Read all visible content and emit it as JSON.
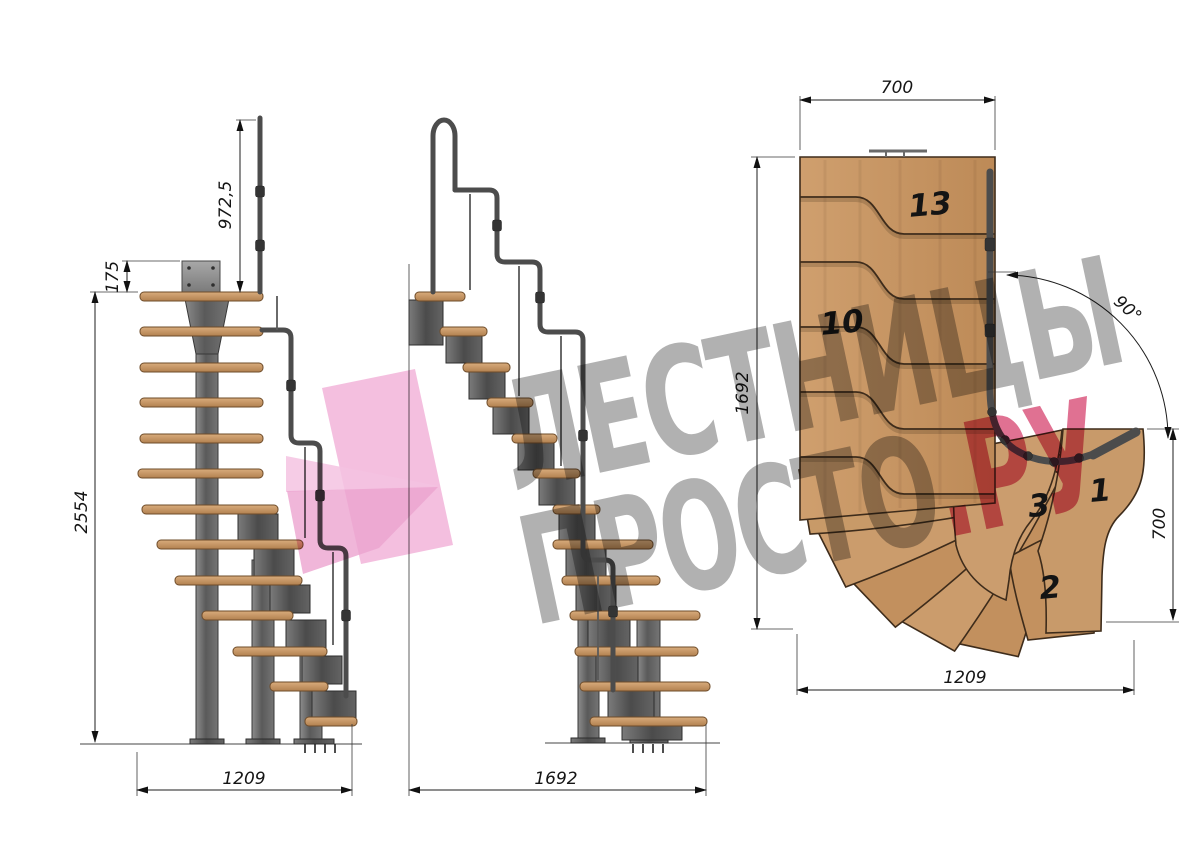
{
  "title": "Modular staircase technical drawing",
  "watermark": {
    "line1": "ЛЕСТНИЦЫ",
    "line2": "ПРОСТО",
    "suffix": ".РУ"
  },
  "views": {
    "side": {
      "label": "side-elevation",
      "dim_rail_height": "972,5",
      "dim_top_offset": "175",
      "dim_total_height": "2554",
      "dim_run": "1209"
    },
    "front": {
      "label": "front-elevation",
      "dim_run": "1692"
    },
    "plan": {
      "label": "plan-view",
      "dim_top_width": "700",
      "dim_left_length": "1692",
      "dim_turn_angle": "90°",
      "dim_right_width": "700",
      "dim_bottom_length": "1209",
      "steps": {
        "s13": "13",
        "s10": "10",
        "s3": "3",
        "s1": "1",
        "s2": "2"
      }
    }
  },
  "colors": {
    "wood": "#c8996a",
    "wood_dark": "#bd8a57",
    "metal": "#6b6b6b",
    "rail": "#4c4c4c",
    "dimension": "#1c1c1c",
    "watermark_gray": "#9b9b9b",
    "watermark_pink": "#d43a68",
    "logo_pink": "#f2b4d9"
  }
}
